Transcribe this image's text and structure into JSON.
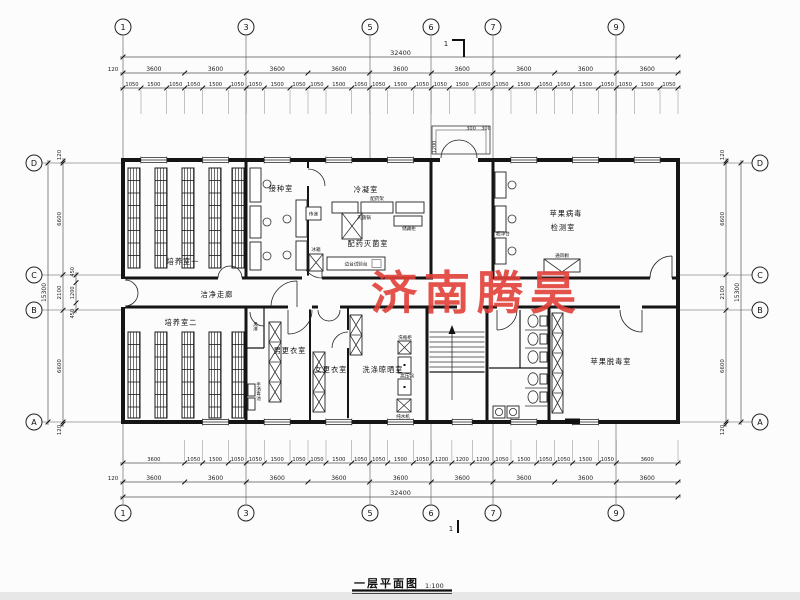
{
  "watermark": {
    "text": "济南腾昊",
    "color": "#e2403a"
  },
  "title_block": {
    "title": "一层平面图",
    "scale": "1:100"
  },
  "section_mark": {
    "label": "1"
  },
  "grid": {
    "top_columns": [
      {
        "label": "1",
        "x": 123
      },
      {
        "label": "3",
        "x": 246
      },
      {
        "label": "5",
        "x": 370
      },
      {
        "label": "6",
        "x": 431
      },
      {
        "label": "7",
        "x": 493
      },
      {
        "label": "9",
        "x": 616
      }
    ],
    "bottom_columns": [
      {
        "label": "1",
        "x": 123
      },
      {
        "label": "3",
        "x": 246
      },
      {
        "label": "5",
        "x": 370
      },
      {
        "label": "6",
        "x": 431
      },
      {
        "label": "7",
        "x": 493
      },
      {
        "label": "9",
        "x": 616
      }
    ],
    "left_rows": [
      {
        "label": "D",
        "y": 163
      },
      {
        "label": "C",
        "y": 275
      },
      {
        "label": "B",
        "y": 310
      },
      {
        "label": "A",
        "y": 422
      }
    ],
    "right_rows": [
      {
        "label": "D",
        "y": 163
      },
      {
        "label": "C",
        "y": 275
      },
      {
        "label": "B",
        "y": 310
      },
      {
        "label": "A",
        "y": 422
      }
    ]
  },
  "dimensions": {
    "top": {
      "total": [
        32400
      ],
      "bays": [
        3600,
        3600,
        3600,
        3600,
        3600,
        3600,
        3600,
        3600,
        3600
      ],
      "edge_offset": "120",
      "windows": [
        1050,
        1500,
        1050,
        1050,
        1500,
        1050,
        1050,
        1500,
        1050,
        1050,
        1500,
        1050,
        1050,
        1500,
        1050,
        1050,
        1500,
        1050,
        1050,
        1500,
        1050,
        1050,
        1500,
        1050,
        1050,
        1500,
        1050
      ]
    },
    "bottom": {
      "total": [
        32400
      ],
      "bays": [
        3600,
        3600,
        3600,
        3600,
        3600,
        3600,
        3600,
        3600,
        3600
      ],
      "edge_offset": "120",
      "windows": [
        3600,
        1050,
        1500,
        1050,
        1050,
        1500,
        1050,
        1050,
        1500,
        1050,
        1050,
        1500,
        1050,
        1200,
        1200,
        1200,
        1050,
        1500,
        1050,
        1050,
        1500,
        1050,
        3600
      ]
    },
    "left": {
      "total": [
        15300
      ],
      "segments": [
        120,
        6600,
        2100,
        6600,
        120
      ],
      "inner": [
        450,
        1200,
        450
      ]
    },
    "right": {
      "total": [
        15300
      ],
      "segments": [
        120,
        6600,
        2100,
        6600,
        120
      ]
    },
    "entrance": {
      "depth": "1200",
      "steps": [
        "300",
        "300"
      ]
    }
  },
  "rooms": {
    "culture1": "培养室一",
    "inoculation": "接种室",
    "condensation": "冷凝室",
    "prep_steril": "配药灭菌室",
    "virus_test_l1": "苹果病毒",
    "virus_test_l2": "检测室",
    "corridor": "洁净走廊",
    "culture2": "培养室二",
    "men_change": "男更衣室",
    "women_change": "女更衣室",
    "wash_dry": "洗涤晾晒室",
    "detox": "苹果脱毒室"
  },
  "equipment": {
    "air_shower": "风淋",
    "hand_wash": "手消毒池",
    "pass_box": "传递",
    "fridge": "冰箱",
    "med_rack": "配药架",
    "sterilizer": "灭菌锅",
    "storage_cabinet": "储藏柜",
    "bench_test": "边台试验台",
    "clean_bench": "超净台",
    "fume_hood": "通风橱",
    "bottle_wash": "洗瓶柜",
    "autoclave": "高压锅",
    "pure_water": "纯水机"
  }
}
